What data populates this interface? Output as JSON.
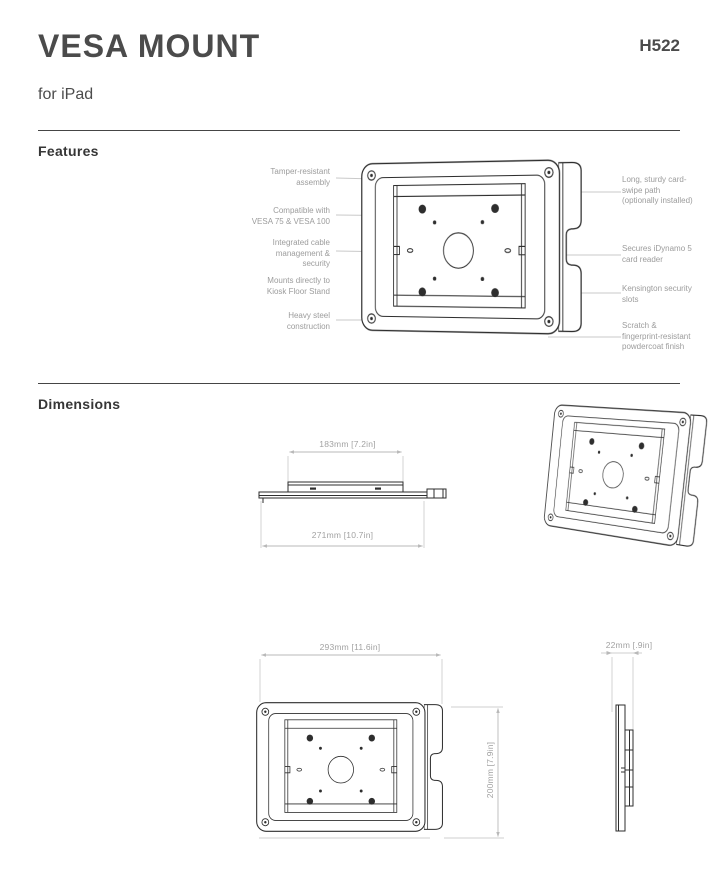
{
  "header": {
    "title": "VESA MOUNT",
    "subtitle": "for iPad",
    "model": "H522"
  },
  "features": {
    "heading": "Features",
    "callouts_left": [
      {
        "label": "Tamper-resistant\nassembly"
      },
      {
        "label": "Compatible with\nVESA 75 & VESA 100"
      },
      {
        "label": "Integrated cable\nmanagement &\nsecurity"
      },
      {
        "label": "Mounts directly to\nKiosk Floor Stand"
      },
      {
        "label": "Heavy steel\nconstruction"
      }
    ],
    "callouts_right": [
      {
        "label": "Long, sturdy card-\nswipe path\n(optionally installed)"
      },
      {
        "label": "Secures iDynamo 5\ncard reader"
      },
      {
        "label": "Kensington security\nslots"
      },
      {
        "label": "Scratch &\nfingerprint-resistant\npowdercoat finish"
      }
    ]
  },
  "dimensions": {
    "heading": "Dimensions",
    "top_profile": {
      "inner_width": "183mm [7.2in]",
      "outer_width": "271mm [10.7in]"
    },
    "front_view": {
      "width": "293mm [11.6in]",
      "height": "200mm [7.9in]"
    },
    "side_profile": {
      "depth": "22mm [.9in]"
    }
  },
  "colors": {
    "line_dark": "#2e2e2e",
    "line_light": "#c9c9c9",
    "label_gray": "#9c9c9c",
    "heading": "#363636"
  }
}
